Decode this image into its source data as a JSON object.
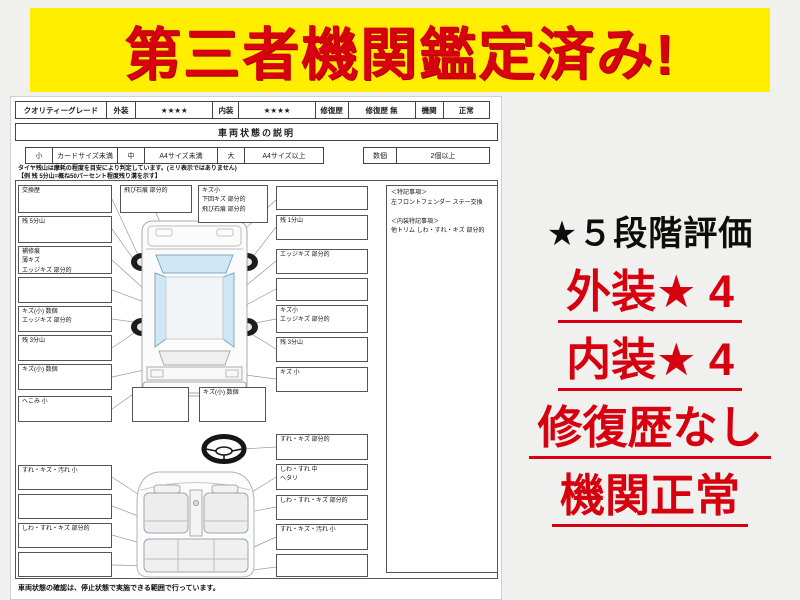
{
  "banner": {
    "text": "第三者機関鑑定済み!",
    "bg_color": "#ffee00",
    "text_color": "#d7000f"
  },
  "grade_bar": {
    "cells": [
      "クオリティーグレード",
      "外装",
      "★★★★",
      "内装",
      "★★★★",
      "修復歴",
      "修復歴 無",
      "機関",
      "正常"
    ]
  },
  "section_title": "車両状態の説明",
  "size_legend": {
    "cells": [
      "小",
      "カードサイズ未満",
      "中",
      "A4サイズ未満",
      "大",
      "A4サイズ以上",
      "数個",
      "2個以上"
    ]
  },
  "tire_note": {
    "line1": "タイヤ残山は摩耗の程度を目安により判定しています。(ミリ表示ではありません)",
    "line2": "【例 残 5分山=概ね50パーセント程度残り溝を示す】"
  },
  "diagram": {
    "left_boxes": [
      {
        "lines": [
          "交換歴"
        ]
      },
      {
        "lines": [
          "残 5分山"
        ]
      },
      {
        "lines": [
          "補修痕",
          "薄キズ",
          "エッジキズ 部分的"
        ]
      },
      {
        "lines": []
      },
      {
        "lines": [
          "キズ(小) 数個",
          "エッジキズ 部分的"
        ]
      },
      {
        "lines": [
          "残 3分山"
        ]
      },
      {
        "lines": [
          "キズ(小) 数個"
        ]
      },
      {
        "lines": [
          "へこみ 小"
        ]
      },
      {
        "lines": [
          "すれ・キズ・汚れ 小"
        ]
      },
      {
        "lines": []
      },
      {
        "lines": [
          "しわ・すれ・キズ 部分的"
        ]
      },
      {
        "lines": []
      }
    ],
    "top_boxes": [
      {
        "lines": [
          "飛び石痕 部分的"
        ]
      },
      {
        "lines": [
          "キズ小",
          "下回キズ 部分的",
          "飛び石痕 部分的"
        ]
      }
    ],
    "right_boxes": [
      {
        "lines": []
      },
      {
        "lines": [
          "残 1分山"
        ]
      },
      {
        "lines": [
          "エッジキズ 部分的"
        ]
      },
      {
        "lines": []
      },
      {
        "lines": [
          "キズ小",
          "エッジキズ 部分的"
        ]
      },
      {
        "lines": [
          "残 3分山"
        ]
      },
      {
        "lines": [
          "キズ 小"
        ]
      },
      {
        "lines": [
          "すれ・キズ 部分的"
        ]
      },
      {
        "lines": [
          "しわ・すれ 中",
          "ヘタリ"
        ]
      },
      {
        "lines": [
          "しわ・すれ・キズ 部分的"
        ]
      },
      {
        "lines": [
          "すれ・キズ・汚れ 小"
        ]
      },
      {
        "lines": []
      }
    ],
    "bottom_boxes": [
      {
        "lines": []
      },
      {
        "lines": [
          "キズ(小) 数個"
        ]
      }
    ],
    "notes": {
      "title1": "＜特記事項＞",
      "item1": "左フロントフェンダー ステー交換",
      "spacer": "",
      "title2": "＜内装特記事項＞",
      "item2": "他トリム しわ・すれ・キズ 部分的"
    }
  },
  "footer_note": "車両状態の確認は、停止状態で実施できる範囲で行っています。",
  "rating_panel": {
    "title": "★５段階評価",
    "lines": [
      "外装★ 4",
      "内装★ 4",
      "修復歴なし",
      "機関正常"
    ]
  }
}
